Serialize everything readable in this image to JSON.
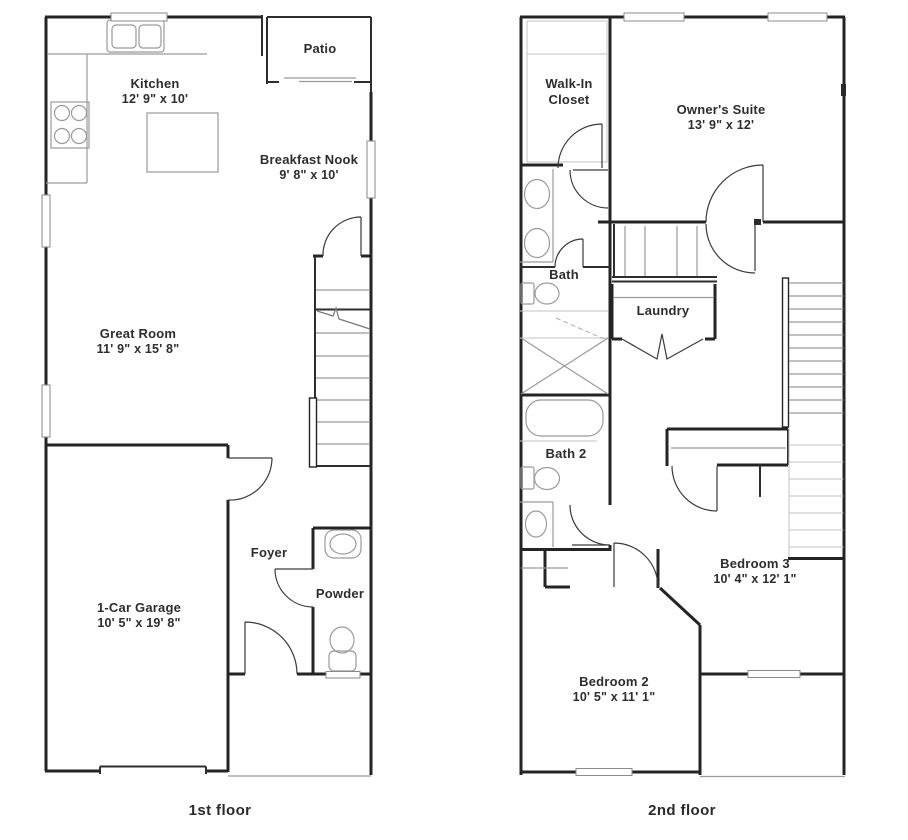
{
  "title": "Two-story home floor plan",
  "colors": {
    "wall": "#242424",
    "fixture": "#9a9a9a",
    "light_line": "#c3c3c3",
    "text": "#2d2d2d",
    "background": "#ffffff"
  },
  "floors": [
    {
      "label": "1st floor",
      "rooms": [
        {
          "name": "Kitchen",
          "dimensions": "12' 9\" x 10'"
        },
        {
          "name": "Patio",
          "dimensions": ""
        },
        {
          "name": "Breakfast Nook",
          "dimensions": "9' 8\" x 10'"
        },
        {
          "name": "Great Room",
          "dimensions": "11' 9\" x 15' 8\""
        },
        {
          "name": "1-Car Garage",
          "dimensions": "10' 5\" x 19' 8\""
        },
        {
          "name": "Foyer",
          "dimensions": ""
        },
        {
          "name": "Powder",
          "dimensions": ""
        }
      ]
    },
    {
      "label": "2nd floor",
      "rooms": [
        {
          "name": "Walk-In Closet",
          "dimensions": ""
        },
        {
          "name": "Owner's Suite",
          "dimensions": "13' 9\" x 12'"
        },
        {
          "name": "Bath",
          "dimensions": ""
        },
        {
          "name": "Laundry",
          "dimensions": ""
        },
        {
          "name": "Bath 2",
          "dimensions": ""
        },
        {
          "name": "Bedroom 3",
          "dimensions": "10' 4\" x 12' 1\""
        },
        {
          "name": "Bedroom 2",
          "dimensions": "10' 5\" x 11' 1\""
        }
      ]
    }
  ]
}
